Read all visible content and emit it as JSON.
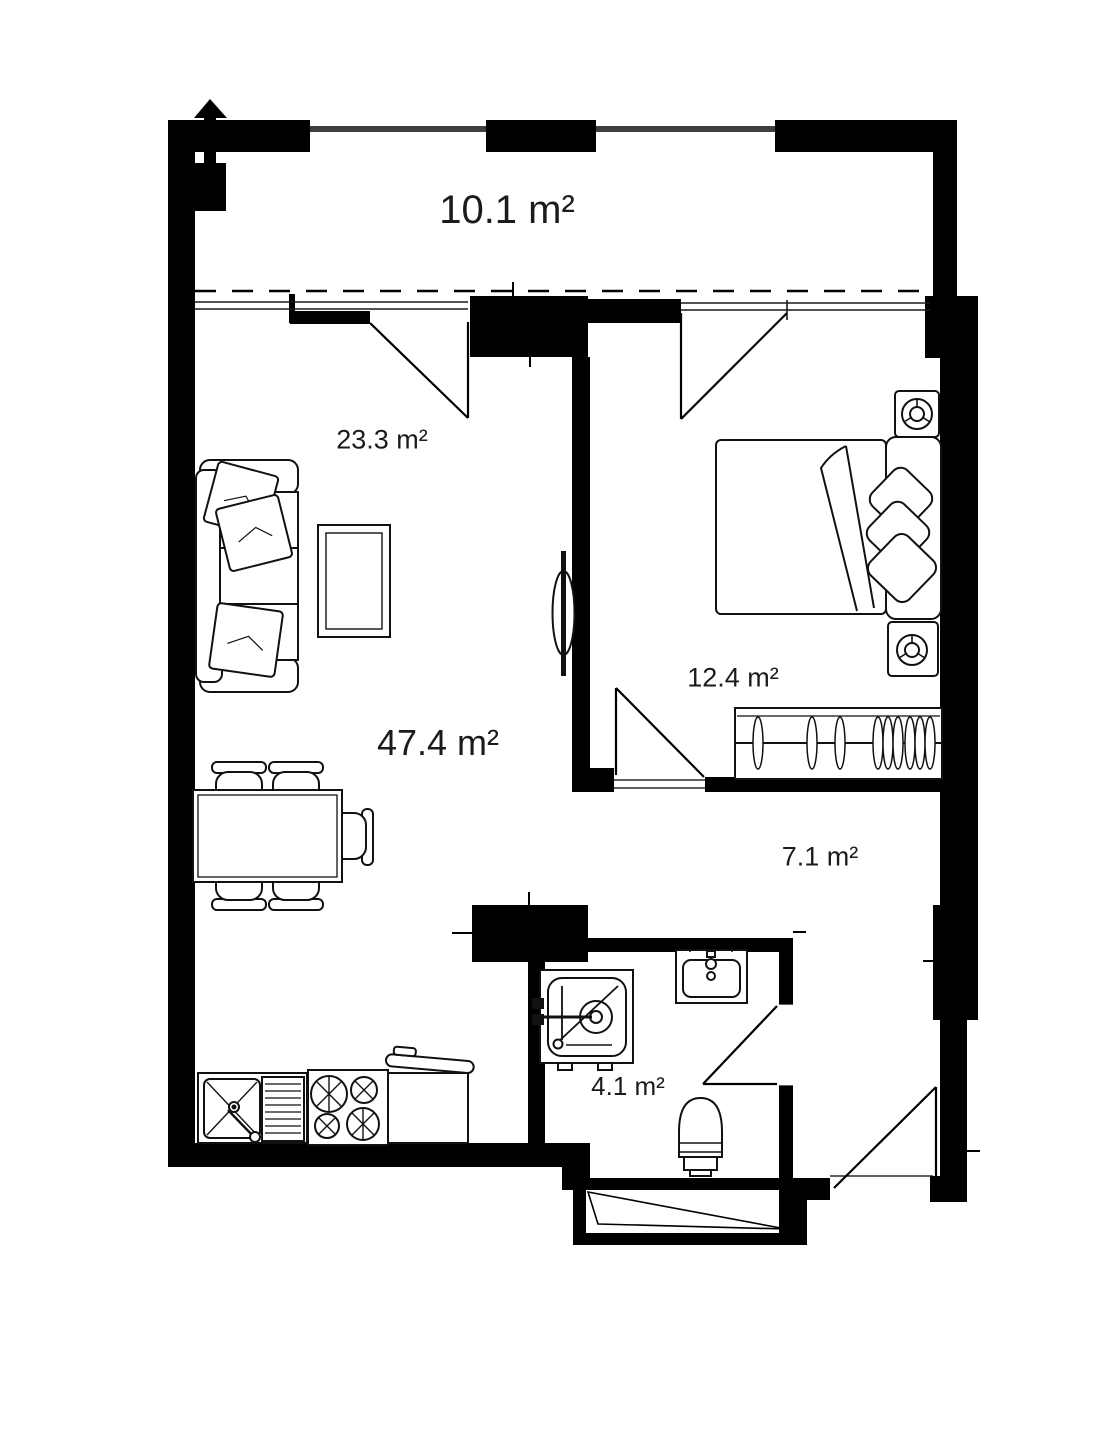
{
  "page": {
    "background_color": "#ffffff",
    "wall_color": "#000000",
    "line_color": "#111111",
    "label_color": "#1b1b1b",
    "railing_color": "#3f3f3f"
  },
  "floor_plan": {
    "rooms": [
      {
        "id": "balcony",
        "area_label": "10.1 m²"
      },
      {
        "id": "living-area",
        "area_label": "23.3 m²"
      },
      {
        "id": "living-total",
        "area_label": "47.4 m²"
      },
      {
        "id": "bedroom",
        "area_label": "12.4 m²"
      },
      {
        "id": "hallway",
        "area_label": "7.1 m²"
      },
      {
        "id": "bathroom",
        "area_label": "4.1 m²"
      }
    ],
    "symbols": [
      "north-arrow",
      "sofa",
      "sofa-pillows",
      "coffee-table",
      "tv",
      "dining-table",
      "dining-chairs",
      "kitchen-sink",
      "stove",
      "trash-bin",
      "bed",
      "headboard",
      "bed-pillows",
      "nightstand-lamps",
      "wardrobe-with-hangers",
      "washing-machine",
      "bathroom-sink",
      "toilet",
      "door-swings",
      "balcony-windows",
      "entrance-door",
      "shaft"
    ]
  }
}
